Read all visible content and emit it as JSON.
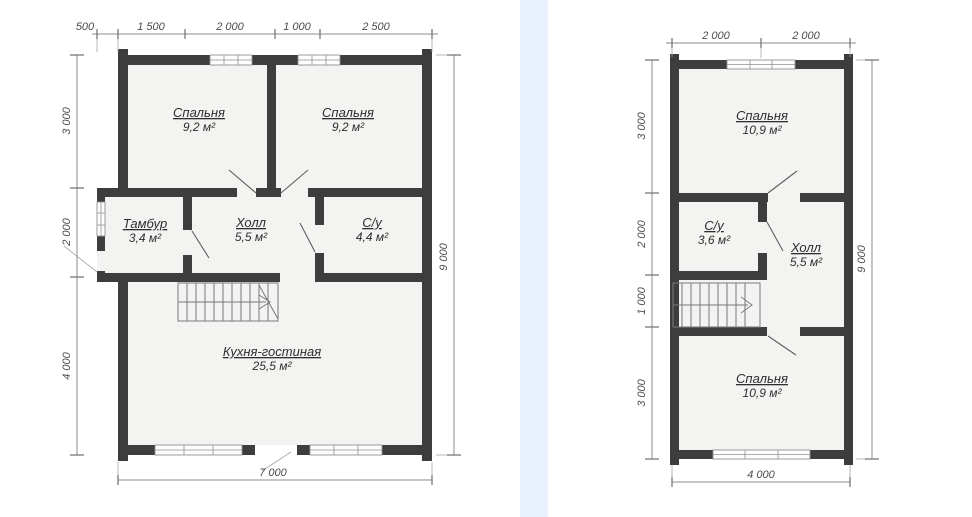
{
  "page": {
    "background_color": "#ffffff",
    "divider_color": "#e9f2fc",
    "wall_color": "#3d3d3d",
    "floor_color": "#f3f3f1",
    "dimension_text_color": "#4c4c4c"
  },
  "plans": [
    {
      "name": "first-floor-plan",
      "rooms": [
        {
          "name": "Спальня",
          "area": "9,2 м²"
        },
        {
          "name": "Спальня",
          "area": "9,2 м²"
        },
        {
          "name": "Тамбур",
          "area": "3,4 м²"
        },
        {
          "name": "Холл",
          "area": "5,5 м²"
        },
        {
          "name": "С/у",
          "area": "4,4 м²"
        },
        {
          "name": "Кухня-гостиная",
          "area": "25,5 м²"
        }
      ],
      "dimensions": {
        "top": [
          "500",
          "1 500",
          "2 000",
          "1 000",
          "2 500"
        ],
        "left": [
          "3 000",
          "2 000",
          "4 000"
        ],
        "right": [
          "9 000"
        ],
        "bottom": [
          "7 000"
        ]
      }
    },
    {
      "name": "second-floor-plan",
      "rooms": [
        {
          "name": "Спальня",
          "area": "10,9 м²"
        },
        {
          "name": "С/у",
          "area": "3,6 м²"
        },
        {
          "name": "Холл",
          "area": "5,5 м²"
        },
        {
          "name": "Спальня",
          "area": "10,9 м²"
        }
      ],
      "dimensions": {
        "top": [
          "2 000",
          "2 000"
        ],
        "left": [
          "3 000",
          "2 000",
          "1 000",
          "3 000"
        ],
        "right": [
          "9 000"
        ],
        "bottom": [
          "4 000"
        ]
      }
    }
  ]
}
